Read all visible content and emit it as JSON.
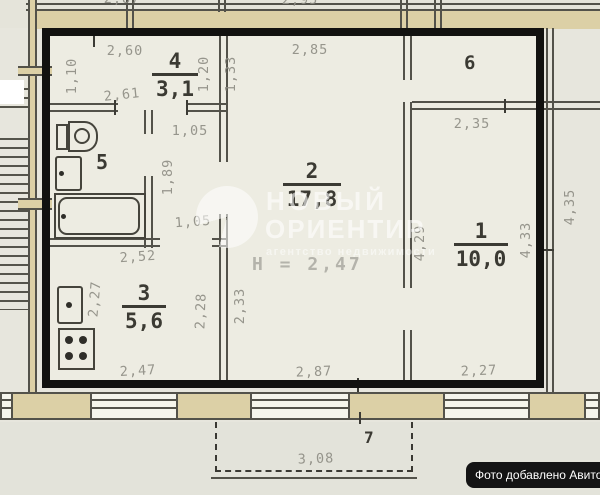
{
  "plan_type": "apartment floor plan (scanned)",
  "rooms": {
    "r1": {
      "num": "1",
      "area": "10,0"
    },
    "r2": {
      "num": "2",
      "area": "17,8"
    },
    "r3": {
      "num": "3",
      "area": "5,6"
    },
    "r4": {
      "num": "4",
      "area": "3,1"
    },
    "r5": {
      "num": "5"
    },
    "r6": {
      "num": "6"
    },
    "r7": {
      "num": "7"
    }
  },
  "dims": {
    "top_left_cut": "2,87",
    "top_mid_cut": "2,95",
    "hall_top": "2,60",
    "hall_bottom": "2,61",
    "hall_left": "1,10",
    "hall_right_inner": "1,20",
    "room2_left_upper": "1,33",
    "room2_top": "2,85",
    "room6_width": "2,35",
    "corridor_top": "1,05",
    "corridor_length": "1,89",
    "corridor_bottom": "1,05",
    "kitchen_top": "2,52",
    "kitchen_left": "2,27",
    "kitchen_right": "2,28",
    "room2_left_lower": "2,33",
    "kitchen_bottom": "2,47",
    "room2_bottom": "2,87",
    "room1_bottom": "2,27",
    "room2_right": "4,29",
    "room1_right": "4,33",
    "outside_right": "4,35",
    "balcony_width": "3,08"
  },
  "annotations": {
    "ceiling_height": "Н = 2,47"
  },
  "watermark": {
    "line1": "НОВЫЙ",
    "line2": "ОРИЕНТИР",
    "line3": "агентство недвижимости"
  },
  "badge": {
    "text": "Фото добавлено Авито"
  },
  "fixtures": [
    "toilet",
    "wash-basin",
    "bathtub",
    "kitchen-sink",
    "stove",
    "staircase",
    "balcony",
    "windows"
  ],
  "colors": {
    "paper": "#e7e6dd",
    "interior": "#edece2",
    "wall_line": "#53524a",
    "exterior_wall_fill": "#dcd0a6",
    "dimension_text": "#8f8e85",
    "label_text": "#3b3a33",
    "apartment_outline": "#121210",
    "badge_bg": "#141414",
    "badge_text": "#ffffff",
    "watermark": "rgba(255,255,255,0.6)"
  }
}
